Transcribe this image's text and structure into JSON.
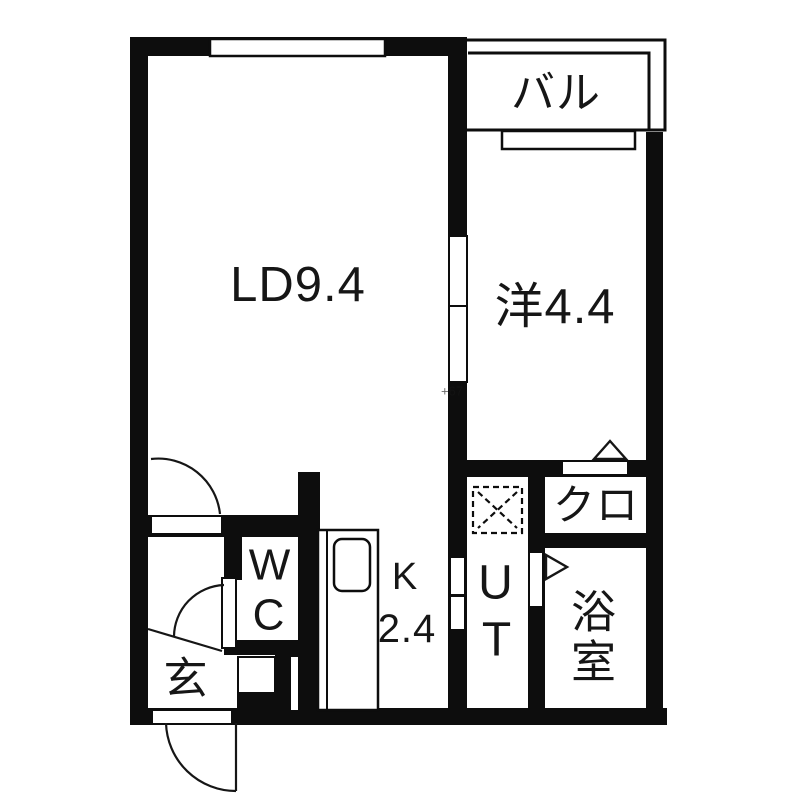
{
  "floorplan": {
    "type": "japanese-apartment-floorplan",
    "colors": {
      "wall": "#0d0d0d",
      "floor": "#ffffff",
      "line": "#161616",
      "watermark": "#8a8a8a"
    },
    "rooms": {
      "living_dining": {
        "label": "LD9.4"
      },
      "western_room": {
        "label": "洋4.4"
      },
      "balcony": {
        "label": "バル"
      },
      "kitchen": {
        "line1": "K",
        "line2": "2.4"
      },
      "toilet": {
        "line1": "W",
        "line2": "C"
      },
      "utility": {
        "line1": "U",
        "line2": "T"
      },
      "closet": {
        "label": "クロ"
      },
      "bathroom": {
        "line1": "浴",
        "line2": "室"
      },
      "entrance": {
        "label": "玄"
      }
    },
    "watermark": "+67"
  }
}
